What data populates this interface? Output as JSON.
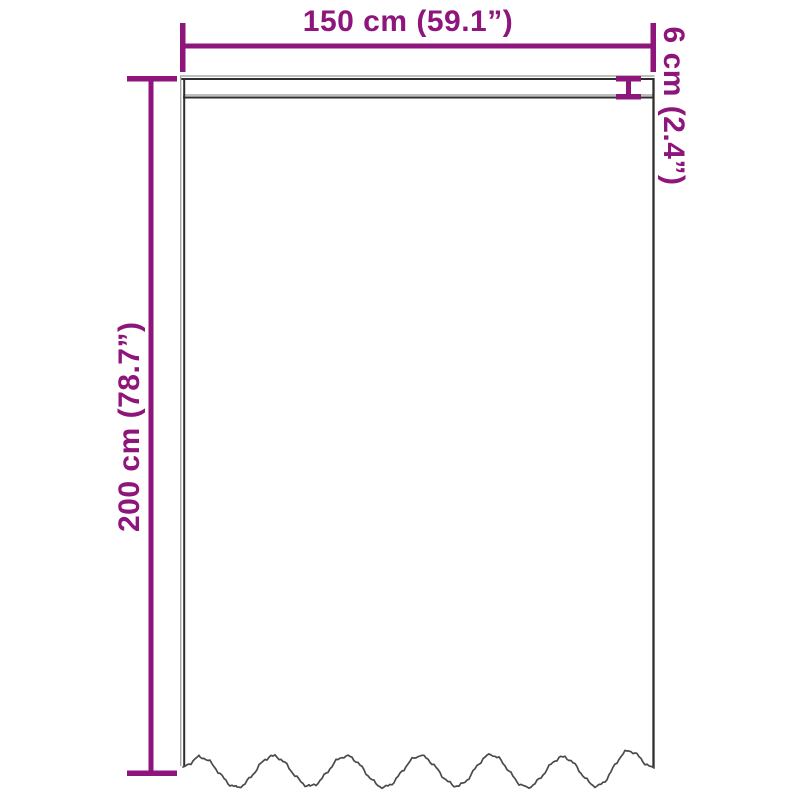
{
  "diagram": {
    "subject": "curtain-with-wavy-hem-dimension-diagram",
    "accent_color": "#8d157b",
    "outline_color": "#2e2e2e",
    "outline_light_color": "#a8a8a8",
    "hem_color": "#4a4a4a",
    "background_color": "#ffffff",
    "dimensions": {
      "width": {
        "label": "150 cm (59.1”)",
        "cm": "150",
        "inches": "59.1",
        "position": "top"
      },
      "height": {
        "label": "200 cm (78.7”)",
        "cm": "200",
        "inches": "78.7",
        "position": "left"
      },
      "header_height": {
        "label": "6 cm (2.4”)",
        "cm": "6",
        "inches": "2.4",
        "position": "top-right"
      }
    }
  }
}
